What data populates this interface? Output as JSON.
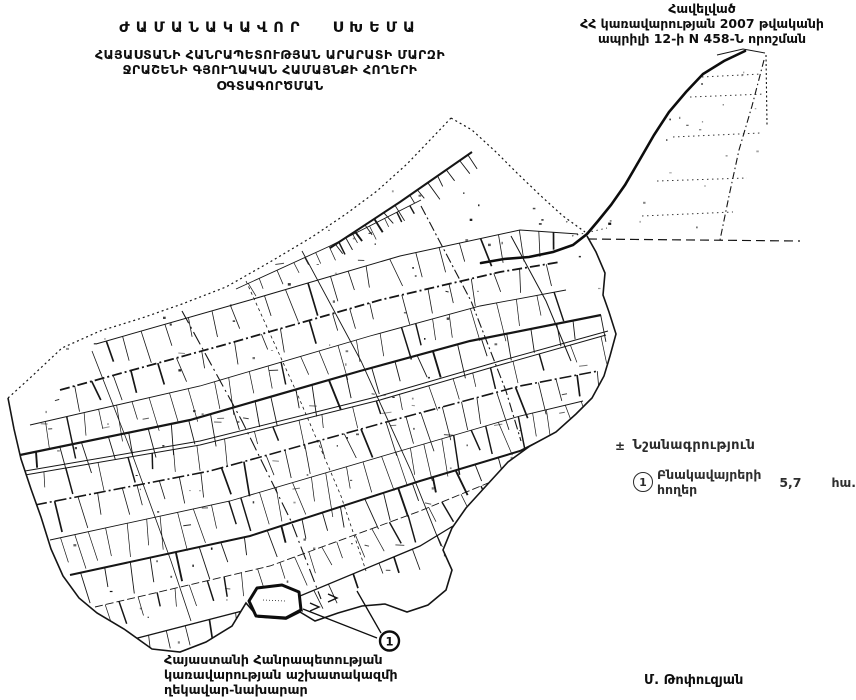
{
  "document": {
    "appendix_note": {
      "line1": "Հավելված",
      "line2": "ՀՀ կառավարության 2007 թվականի",
      "line3": "ապրիլի 12-ի N 458-Ն որոշման"
    },
    "title": {
      "main": "ԺԱՄԱՆԱԿԱՎՈՐ ՍԽԵՄԱ",
      "sub1": "ՀԱՅԱՍՏԱՆԻ ՀԱՆՐԱՊԵՏՈՒԹՅԱՆ ԱՐԱՐԱՏԻ ՄԱՐԶԻ",
      "sub2": "ՋՐԱՇԵՆԻ ԳՅՈՒՂԱԿԱՆ ՀԱՄԱՅՆՔԻ ՀՈՂԵՐԻ",
      "sub3": "ՕԳՏԱԳՈՐԾՄԱՆ"
    },
    "legend": {
      "bullet": "±",
      "header": "Նշանագրություն",
      "item": {
        "marker": "1",
        "label": "Բնակավայրերի հողեր",
        "area": "5,7",
        "unit": "հա."
      }
    },
    "map_marker": "1",
    "signatory": {
      "org_line1": "Հայաստանի Հանրապետության",
      "org_line2": "կառավարության աշխատակազմի",
      "org_line3": "ղեկավար-նախարար",
      "name": "Մ. Թոփուզյան"
    },
    "colors": {
      "ink": "#151515",
      "paper": "#ffffff"
    }
  }
}
